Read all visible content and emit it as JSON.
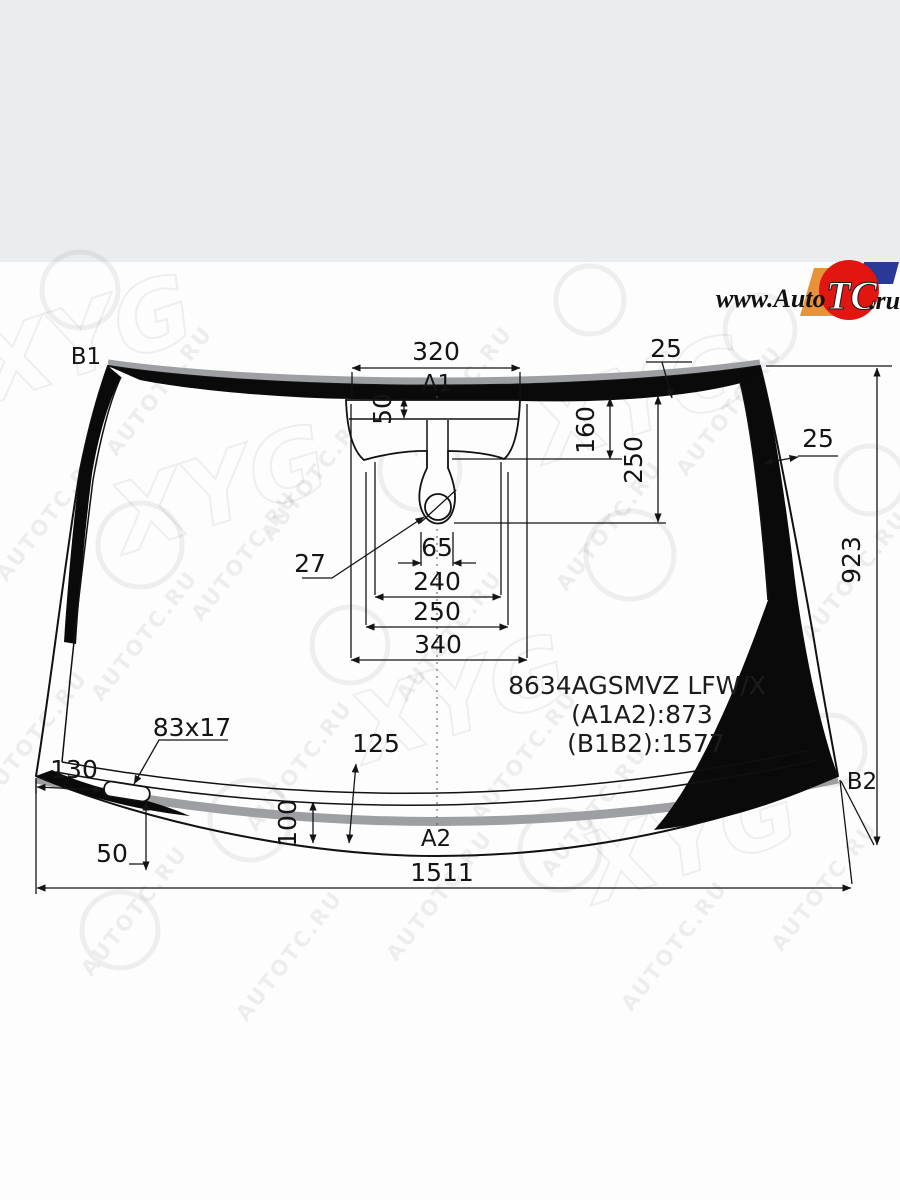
{
  "colors": {
    "top_band": "#ebecee",
    "edge_gray": "#9d9fa2",
    "logo_red": "#e21510",
    "logo_orange": "#e8923a",
    "logo_blue": "#2a3896"
  },
  "logo": {
    "prefix": "www.Auto",
    "tc": "TC",
    "suffix": ".ru"
  },
  "watermark": {
    "text": "AUTOTC.RU",
    "brand": "XYG"
  },
  "labels": {
    "b1": "B1",
    "b2": "B2",
    "a1": "A1",
    "a2": "A2"
  },
  "dims": {
    "top_width": "320",
    "band_top": "25",
    "band_side": "25",
    "notch": "50",
    "d160": "160",
    "d250_side": "250",
    "height": "923",
    "mirror": "27",
    "stem": "65",
    "w240": "240",
    "w250": "250",
    "w340": "340",
    "pad": "83x17",
    "d130": "130",
    "d50": "50",
    "d100": "100",
    "d125": "125",
    "bottom_width": "1511"
  },
  "part": {
    "code": "8634AGSMVZ LFW/X",
    "a1a2": "(A1A2):873",
    "b1b2": "(B1B2):1577"
  }
}
